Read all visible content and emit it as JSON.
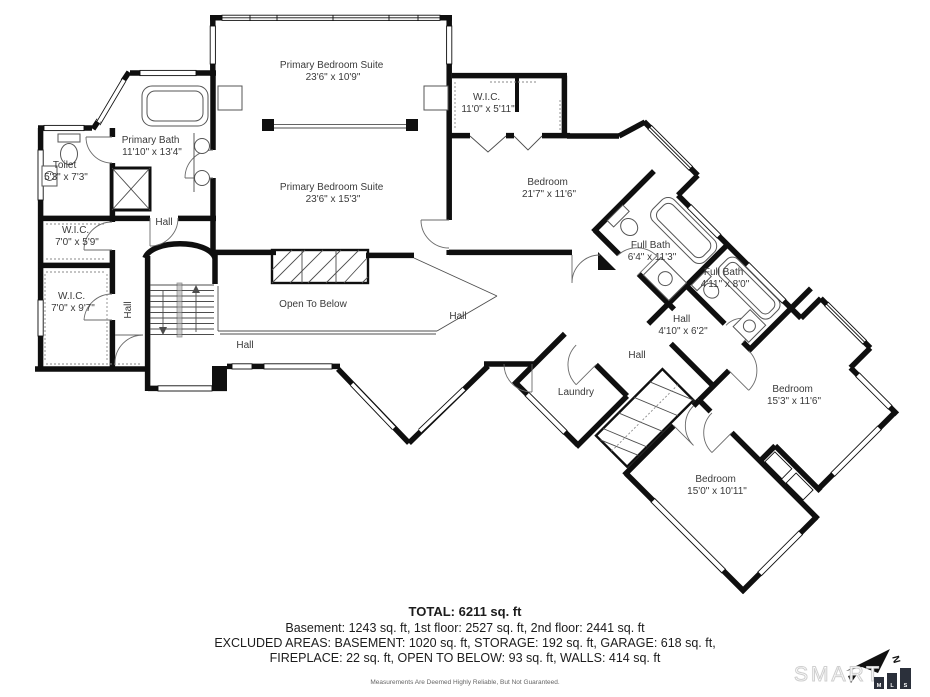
{
  "plan": {
    "rooms": [
      {
        "name": "Primary Bedroom Suite",
        "dims": "23'6\" x 10'9\""
      },
      {
        "name": "W.I.C.",
        "dims": "11'0\" x 5'11\""
      },
      {
        "name": "Primary Bath",
        "dims": "11'10\" x 13'4\""
      },
      {
        "name": "Toilet",
        "dims": "5'3\" x 7'3\""
      },
      {
        "name": "Primary Bedroom Suite",
        "dims": "23'6\" x 15'3\""
      },
      {
        "name": "Bedroom",
        "dims": "21'7\" x 11'6\""
      },
      {
        "name": "W.I.C.",
        "dims": "7'0\" x 5'9\""
      },
      {
        "name": "W.I.C.",
        "dims": "7'0\" x 9'7\""
      },
      {
        "name": "Full Bath",
        "dims": "6'4\" x 11'3\""
      },
      {
        "name": "Full Bath",
        "dims": "4'11\" x 8'0\""
      },
      {
        "name": "Hall",
        "dims": "4'10\" x 6'2\""
      },
      {
        "name": "Bedroom",
        "dims": "15'3\" x 11'6\""
      },
      {
        "name": "Bedroom",
        "dims": "15'0\" x 10'11\""
      }
    ],
    "labels": [
      {
        "text": "Hall"
      },
      {
        "text": "Hall"
      },
      {
        "text": "Open To Below"
      },
      {
        "text": "Hall"
      },
      {
        "text": "Hall"
      },
      {
        "text": "Hall"
      },
      {
        "text": "Laundry"
      }
    ]
  },
  "summary": {
    "total": "TOTAL: 6211 sq. ft",
    "line1": "Basement: 1243 sq. ft, 1st floor: 2527 sq. ft, 2nd floor: 2441 sq. ft",
    "line2": "EXCLUDED AREAS: BASEMENT: 1020 sq. ft, STORAGE: 192 sq. ft, GARAGE: 618 sq. ft,",
    "line3": "FIREPLACE: 22 sq. ft, OPEN TO BELOW: 93 sq. ft, WALLS: 414 sq. ft",
    "disclaimer": "Measurements Are Deemed Highly Reliable, But Not Guaranteed."
  },
  "logo": {
    "word": "SMART",
    "mls": [
      "M",
      "L",
      "S"
    ],
    "north": "N"
  },
  "colors": {
    "walls": "#0f0f0f",
    "logo_bars": "#2b303b",
    "label_text": "#3a3a3a"
  }
}
